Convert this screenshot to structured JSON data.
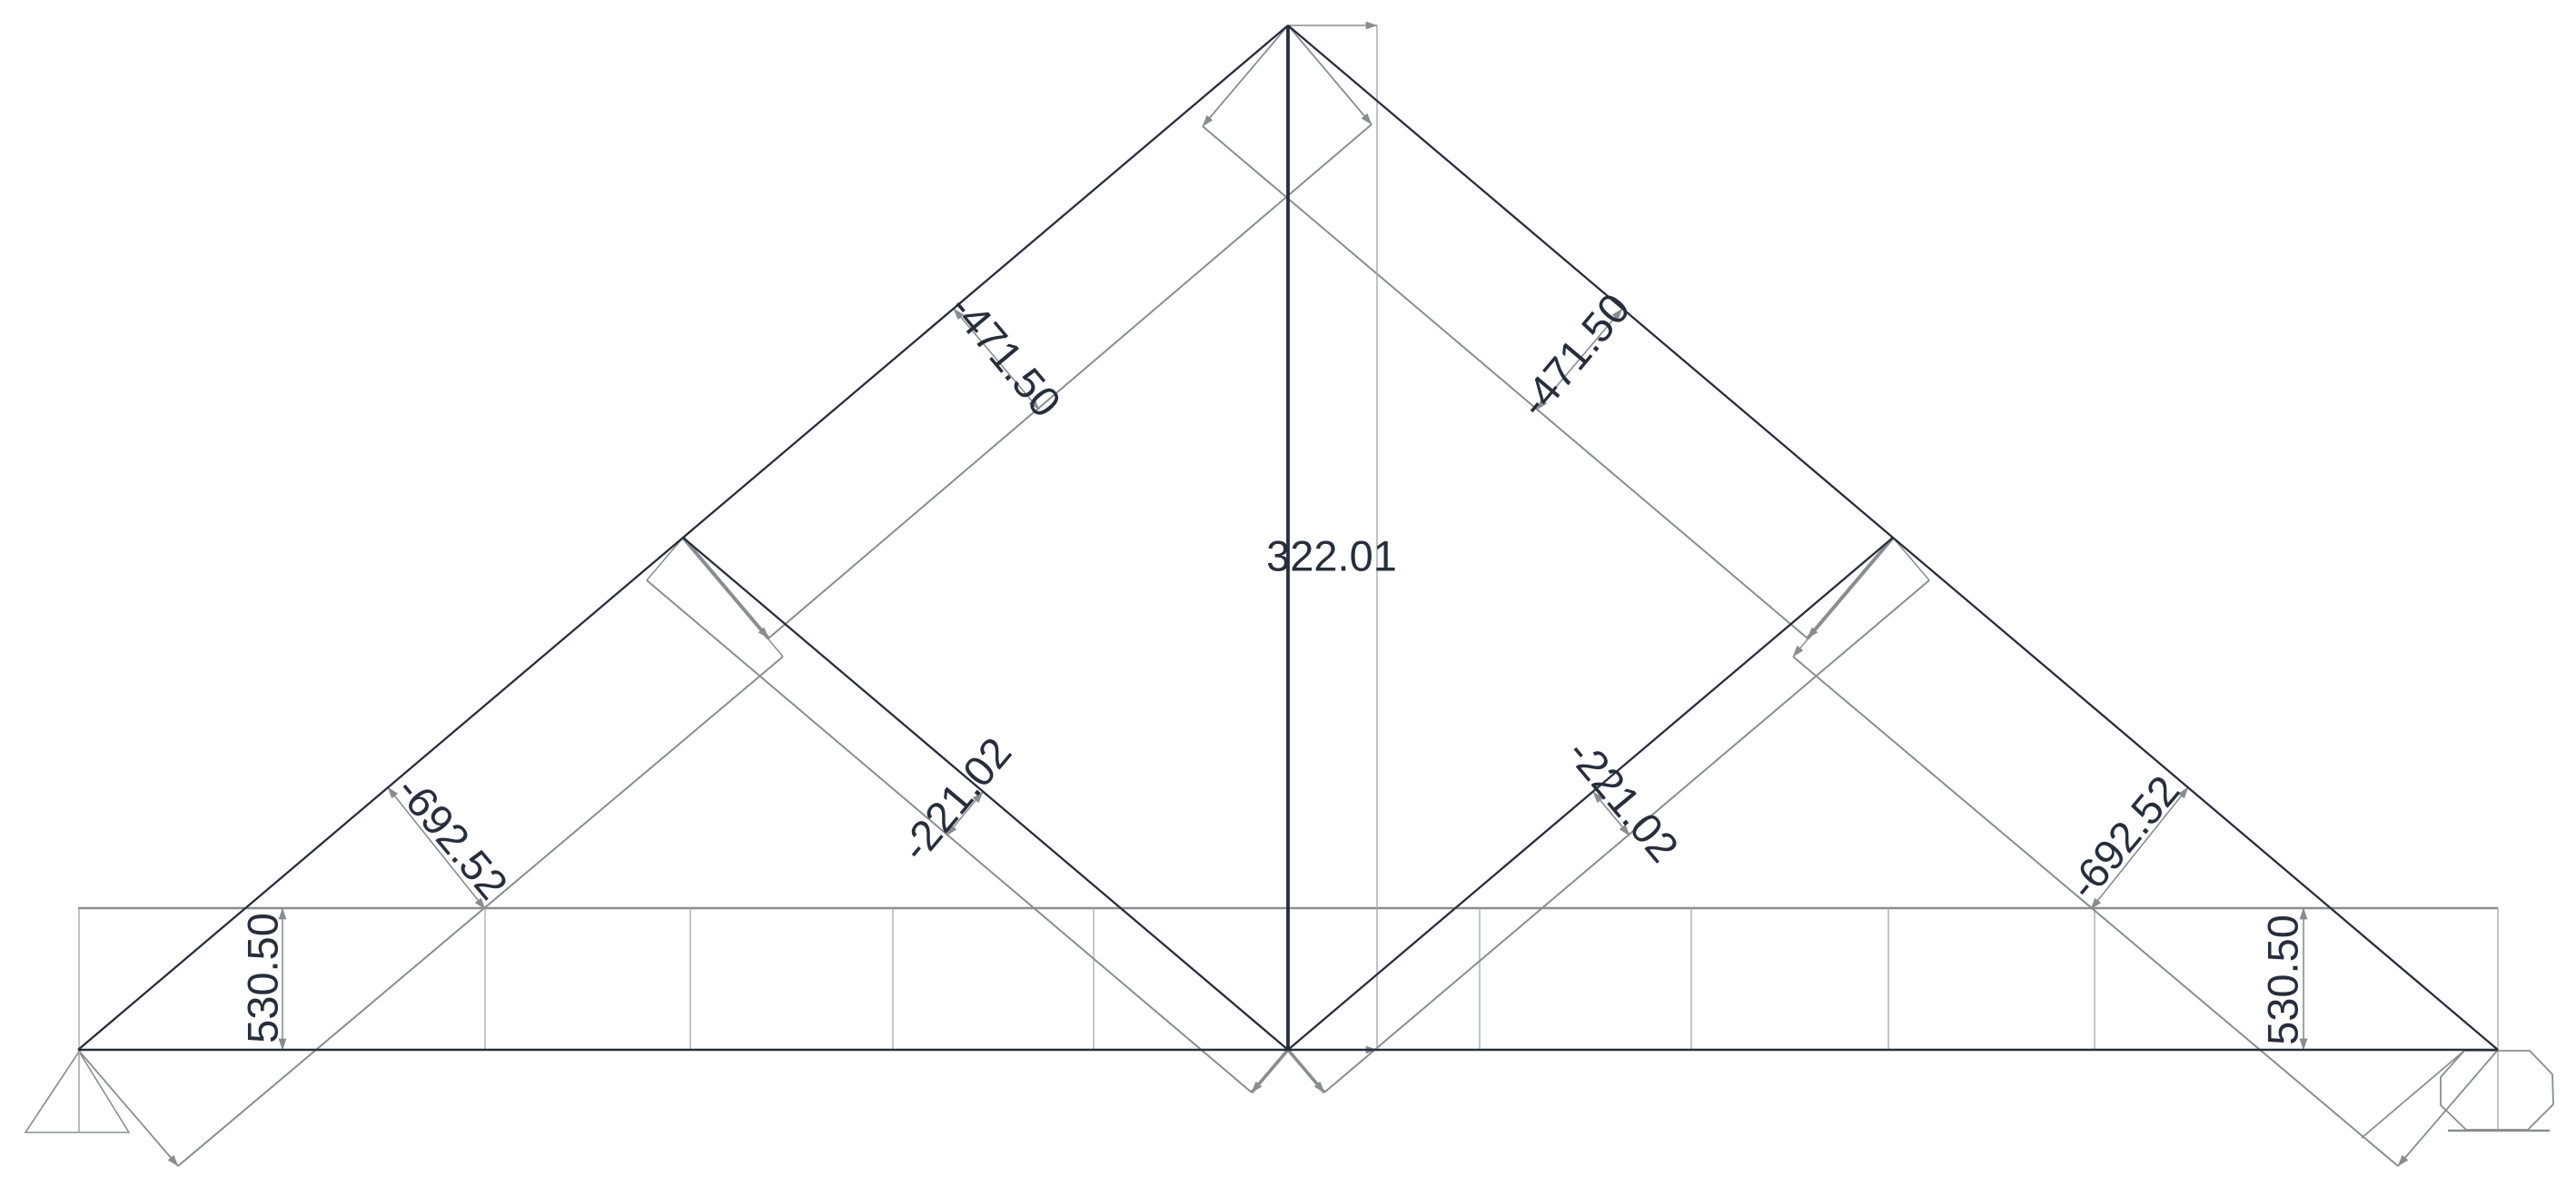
{
  "chart_data": {
    "type": "diagram",
    "subtype": "truss-axial-force-diagram",
    "description": "King-post truss with struts shown with its axial force diagram; member force values annotated along perpendicular dimension lines",
    "members": [
      {
        "id": "top-chord-upper-left",
        "force": "-471.50"
      },
      {
        "id": "top-chord-upper-right",
        "force": "-471.50"
      },
      {
        "id": "top-chord-lower-left",
        "force": "-692.52"
      },
      {
        "id": "top-chord-lower-right",
        "force": "-692.52"
      },
      {
        "id": "strut-left",
        "force": "-221.02"
      },
      {
        "id": "strut-right",
        "force": "-221.02"
      },
      {
        "id": "king-post",
        "force": "322.01"
      },
      {
        "id": "bottom-chord-left",
        "force": "530.50"
      },
      {
        "id": "bottom-chord-right",
        "force": "530.50"
      }
    ],
    "supports": [
      "pin-left",
      "roller-right"
    ],
    "legend_position": "none",
    "grid": false,
    "colors": {
      "member": "#272e3b",
      "diagram_line": "#8a8d90",
      "hairline": "#a6a9ab",
      "label": "#272e3b",
      "background": "#ffffff"
    }
  }
}
